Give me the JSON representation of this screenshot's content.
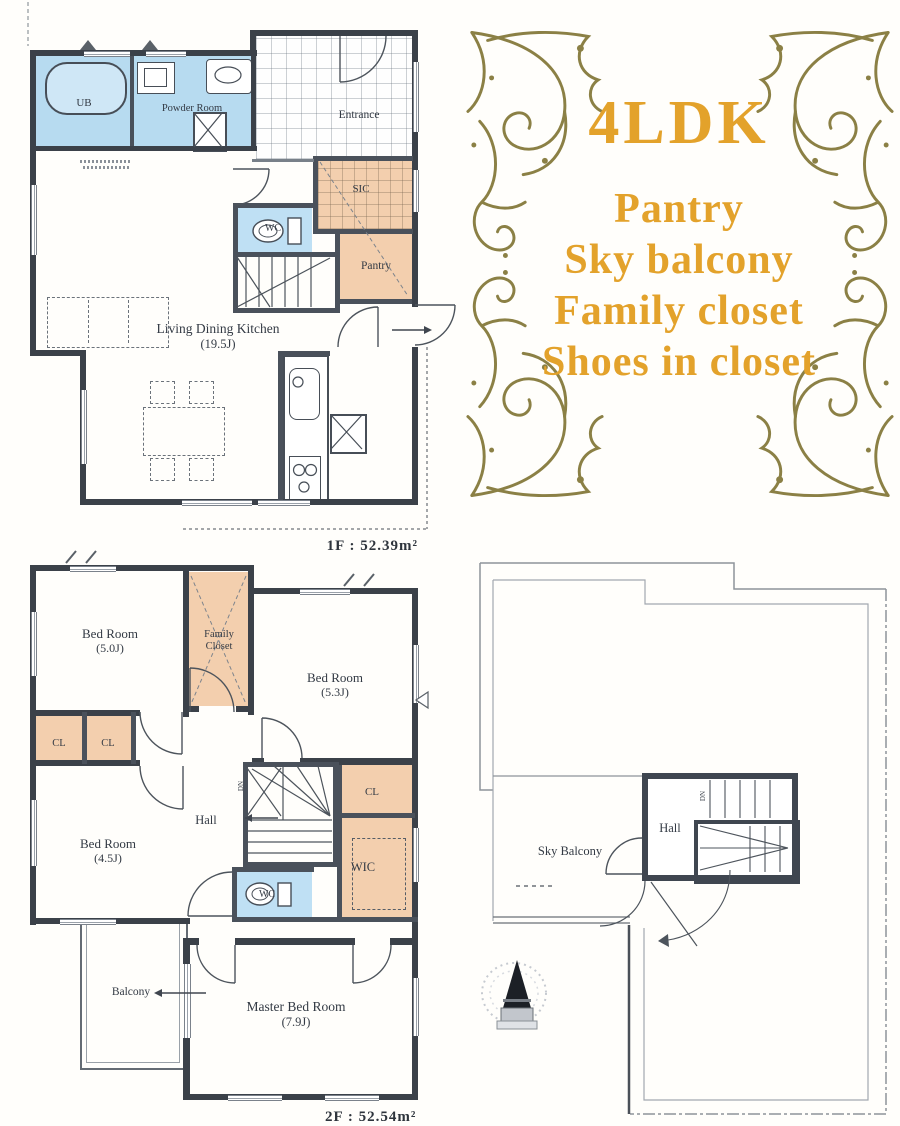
{
  "panel": {
    "title": "4LDK",
    "features": [
      "Pantry",
      "Sky balcony",
      "Family closet",
      "Shoes in closet"
    ]
  },
  "floor1": {
    "area_label": "1F : 52.39m²",
    "rooms": {
      "ub": "UB",
      "powder": "Powder Room",
      "entrance": "Entrance",
      "wc": "WC",
      "sic": "SIC",
      "pantry": "Pantry",
      "ldk": {
        "name": "Living Dining Kitchen",
        "size": "(19.5J)"
      }
    }
  },
  "floor2": {
    "area_label": "2F : 52.54m²",
    "rooms": {
      "bed1": {
        "name": "Bed Room",
        "size": "(5.0J)"
      },
      "family_closet": {
        "line1": "Family",
        "line2": "Closet"
      },
      "bed2": {
        "name": "Bed Room",
        "size": "(5.3J)"
      },
      "cl_a": "CL",
      "cl_b": "CL",
      "cl_c": "CL",
      "hall": "Hall",
      "wic": "WIC",
      "wc": "WC",
      "bed3": {
        "name": "Bed Room",
        "size": "(4.5J)"
      },
      "balcony": "Balcony",
      "master": {
        "name": "Master Bed Room",
        "size": "(7.9J)"
      },
      "stairs_dn": "DN"
    }
  },
  "roof": {
    "sky_balcony": "Sky Balcony",
    "hall": "Hall",
    "stairs_dn": "DN"
  },
  "colors": {
    "room_blue": "#b7dbf0",
    "room_peach": "#f3cfae",
    "wall_dark": "#3b4149",
    "gold": "#e3a22b",
    "flourish_olive": "#8b8045"
  }
}
